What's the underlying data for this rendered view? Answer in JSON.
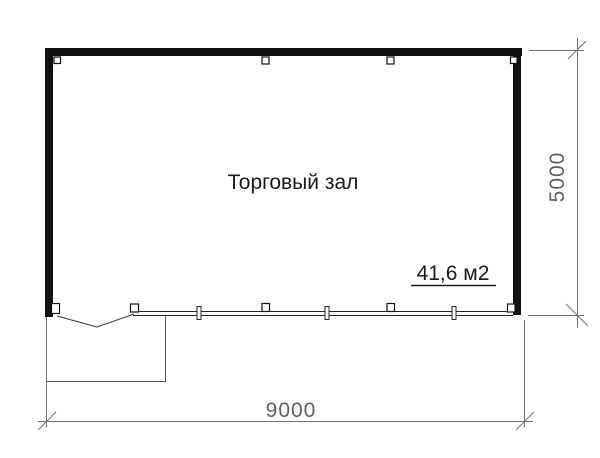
{
  "plan": {
    "room": {
      "label": "Торговый зал",
      "area": "41,6 м2"
    },
    "dimensions": {
      "width": "9000",
      "height": "5000"
    },
    "colors": {
      "wall": "#111111",
      "window_line": "#222222",
      "door_line": "#333333",
      "porch_line": "#555555",
      "dimension_line": "#707070",
      "dimension_text": "#5f5f5f",
      "label_text": "#1a1a1a",
      "background": "#ffffff"
    }
  }
}
